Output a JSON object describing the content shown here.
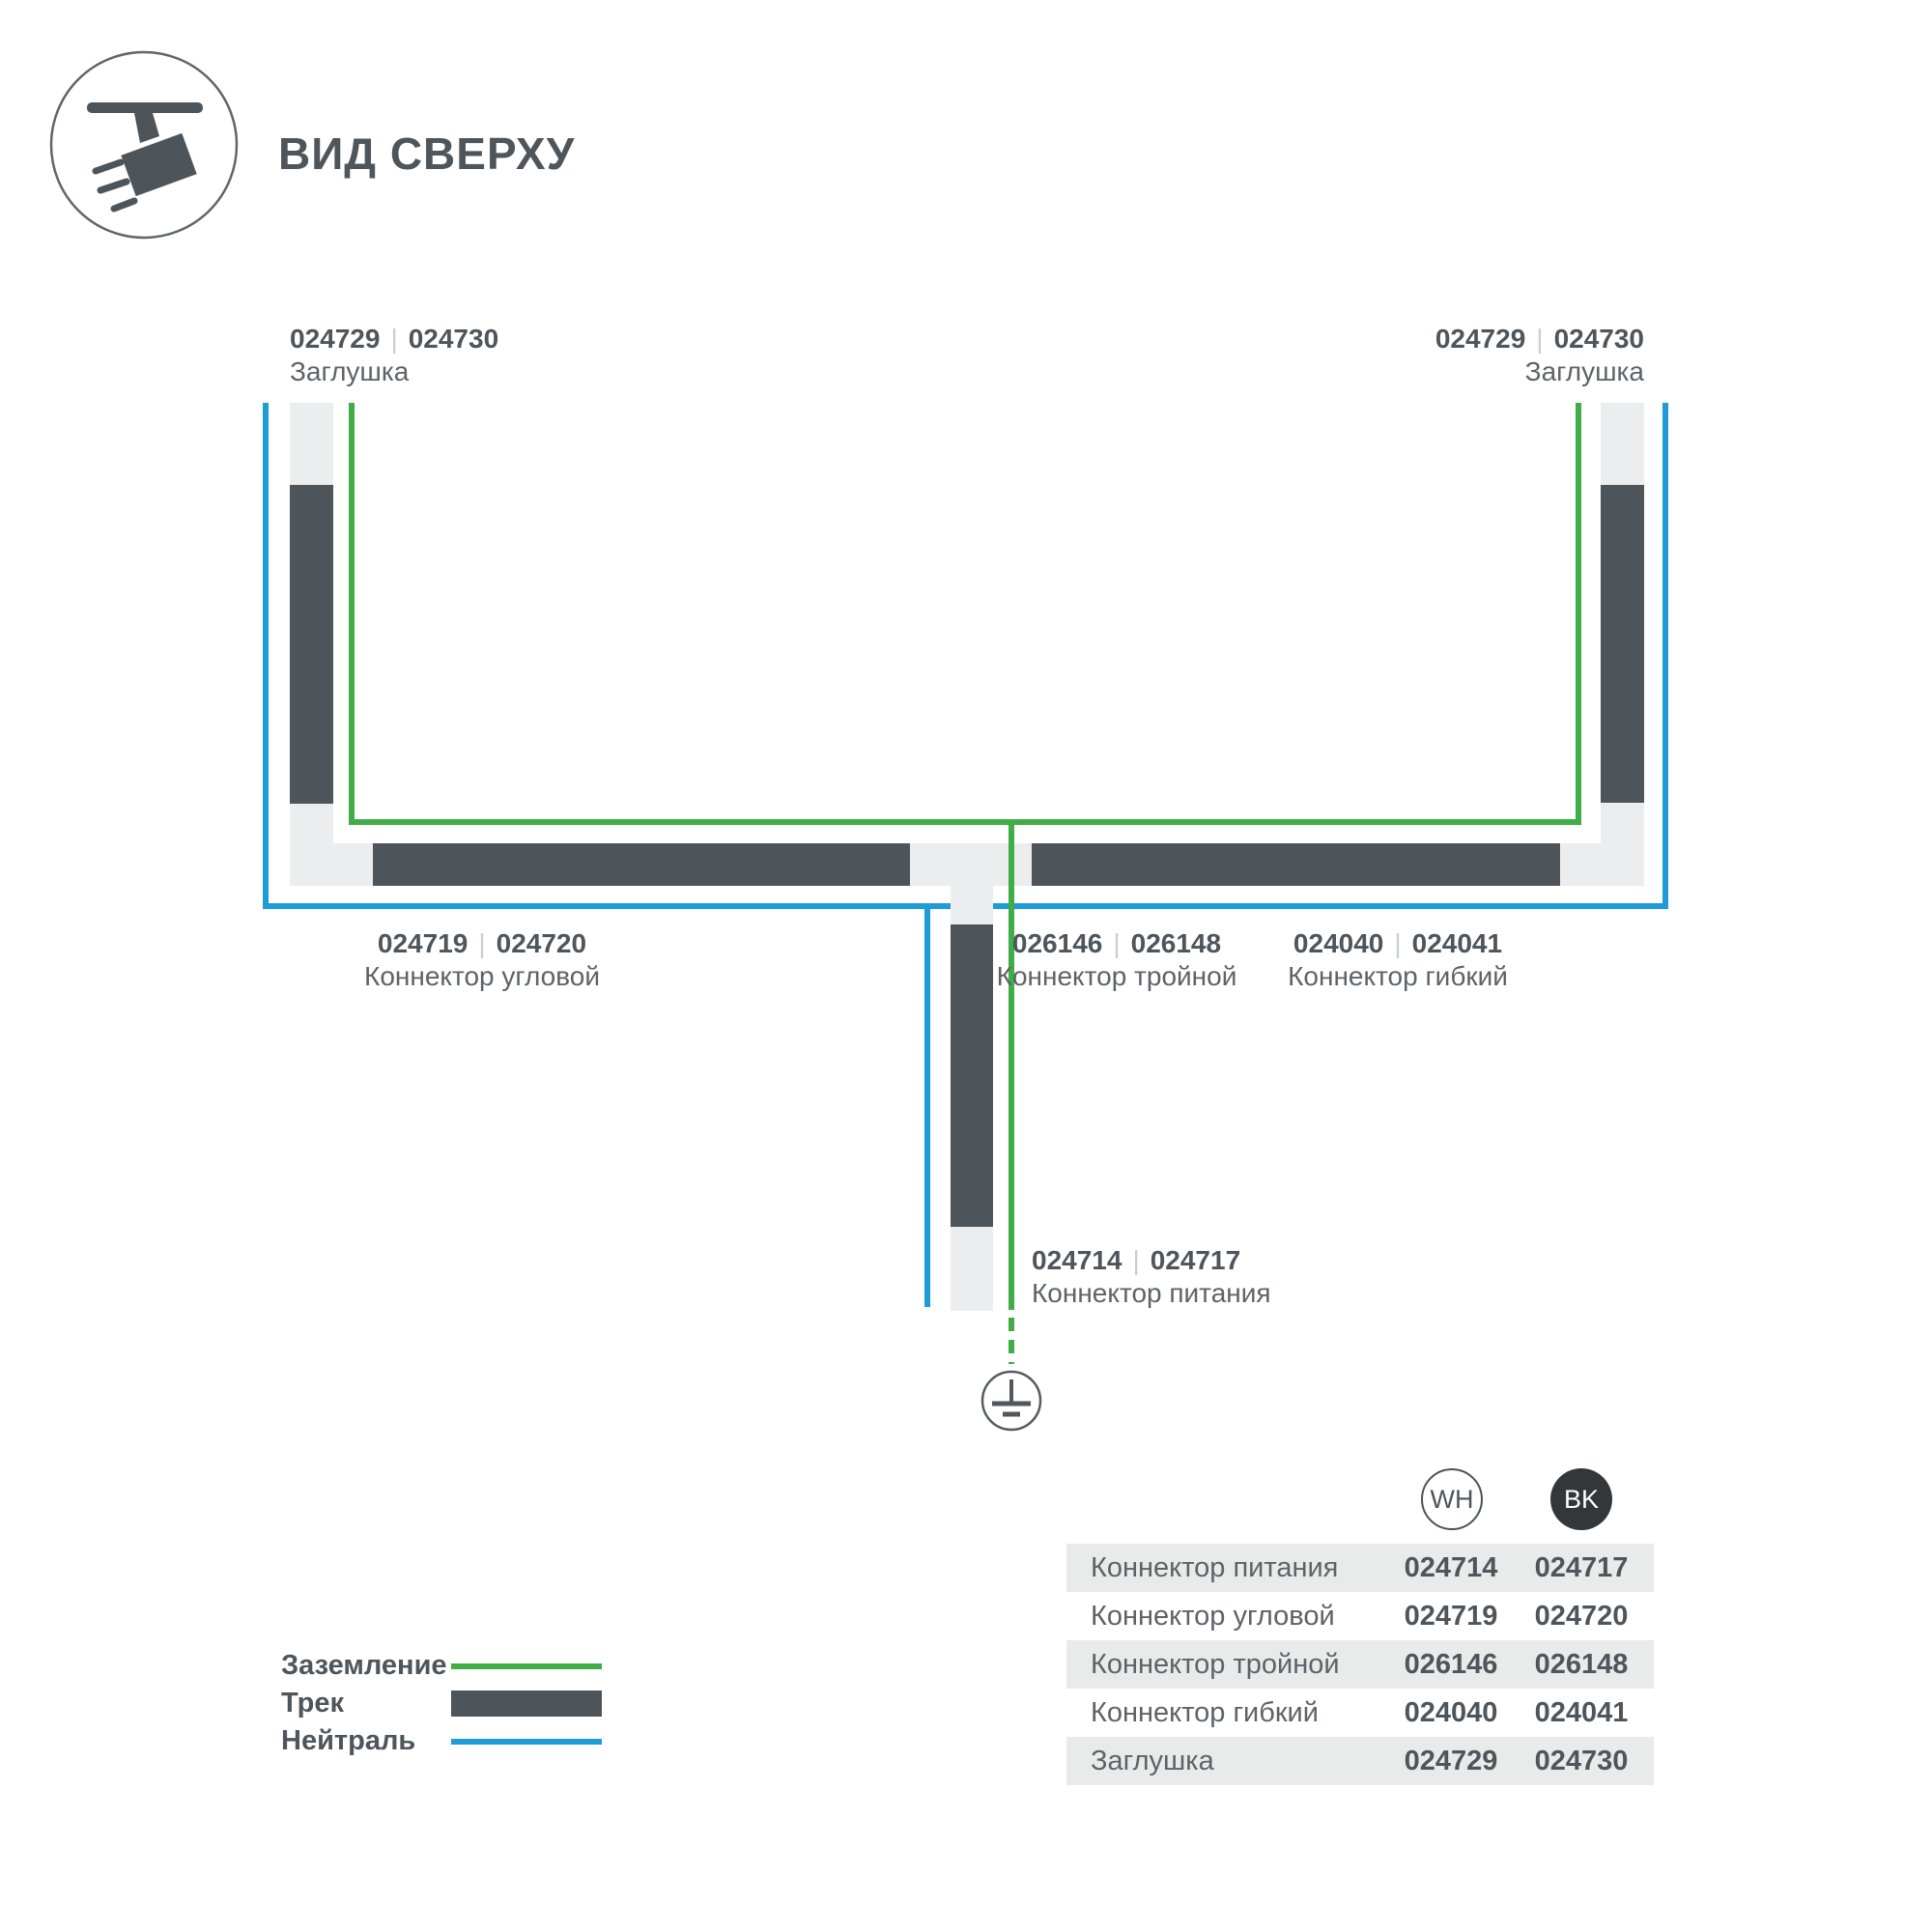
{
  "header": {
    "title": "ВИД СВЕРХУ"
  },
  "sep": "|",
  "diagram": {
    "labels": {
      "endcap_left": {
        "num_wh": "024729",
        "num_bk": "024730",
        "name": "Заглушка"
      },
      "endcap_right": {
        "num_wh": "024729",
        "num_bk": "024730",
        "name": "Заглушка"
      },
      "corner": {
        "num_wh": "024719",
        "num_bk": "024720",
        "name": "Коннектор угловой"
      },
      "triple": {
        "num_wh": "026146",
        "num_bk": "026148",
        "name": "Коннектор тройной"
      },
      "flex": {
        "num_wh": "024040",
        "num_bk": "024041",
        "name": "Коннектор гибкий"
      },
      "power": {
        "num_wh": "024714",
        "num_bk": "024717",
        "name": "Коннектор питания"
      }
    }
  },
  "legend": {
    "items": [
      {
        "label": "Заземление",
        "swatch": "ground-green-line"
      },
      {
        "label": "Трек",
        "swatch": "track-dark-bar"
      },
      {
        "label": "Нейтраль",
        "swatch": "neutral-blue-line"
      }
    ]
  },
  "table": {
    "columns": [
      {
        "code": "WH"
      },
      {
        "code": "BK"
      }
    ],
    "rows": [
      {
        "name": "Коннектор питания",
        "wh": "024714",
        "bk": "024717"
      },
      {
        "name": "Коннектор угловой",
        "wh": "024719",
        "bk": "024720"
      },
      {
        "name": "Коннектор тройной",
        "wh": "026146",
        "bk": "026148"
      },
      {
        "name": "Коннектор гибкий",
        "wh": "024040",
        "bk": "024041"
      },
      {
        "name": "Заглушка",
        "wh": "024729",
        "bk": "024730"
      }
    ]
  },
  "colors": {
    "ground_green": "#41ad49",
    "neutral_blue": "#1e9cd8",
    "track_dark": "#4d545a",
    "rail_light": "#ebedee",
    "row_gray": "#e9ebeb",
    "bk_circle": "#33373a",
    "text_dark": "#4e555b",
    "text_mid": "#5d6368",
    "pipe_gray": "#cbced1"
  }
}
